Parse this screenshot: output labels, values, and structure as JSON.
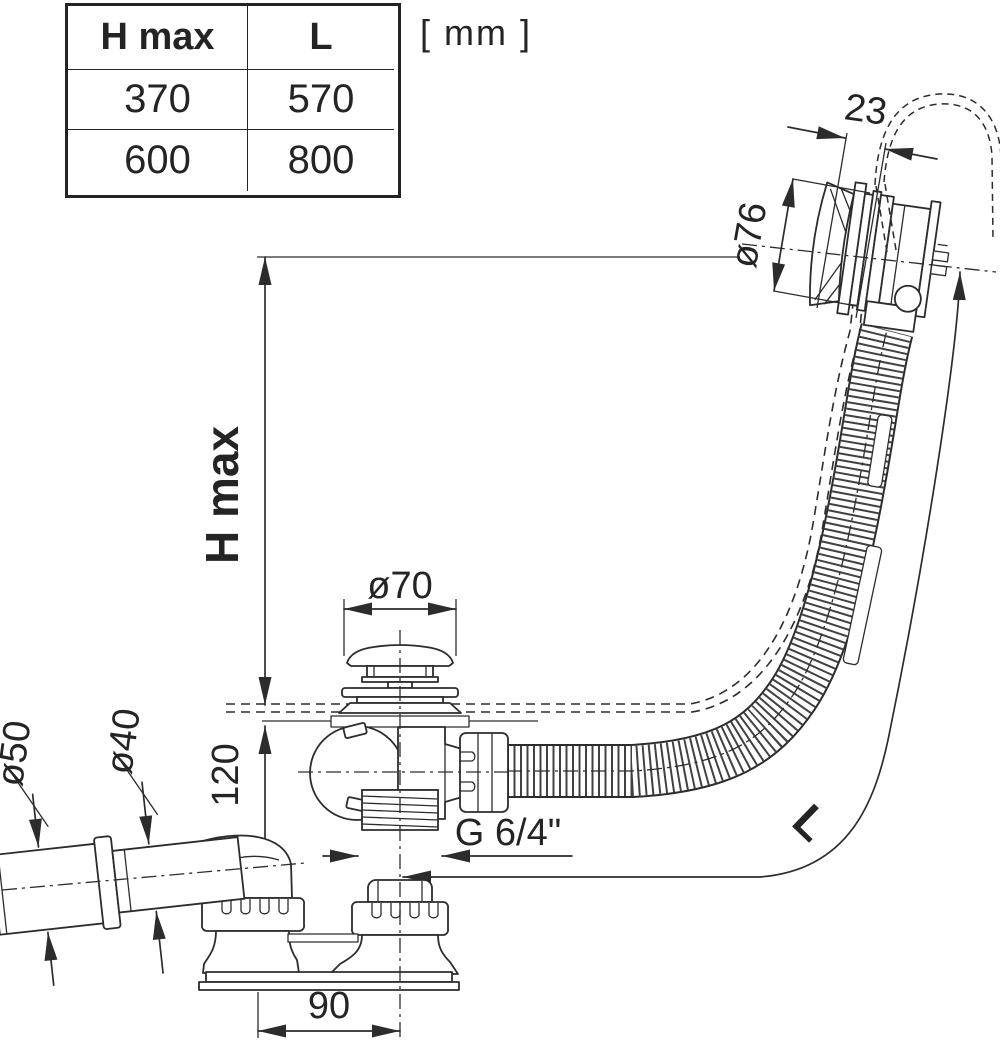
{
  "units_label": "[ mm ]",
  "table": {
    "headers": [
      "H max",
      "L"
    ],
    "rows": [
      [
        "370",
        "570"
      ],
      [
        "600",
        "800"
      ]
    ]
  },
  "dimensions": {
    "h_max": "H max",
    "h120": "120",
    "dia70": "ø70",
    "dia50": "ø50",
    "dia40": "ø40",
    "d23": "23",
    "dia76": "ø76",
    "thread": "G 6/4\"",
    "d90": "90",
    "length": "L"
  },
  "drawing": {
    "type": "technical-drawing",
    "subject": "bath waste and overflow set with bowden-cable overflow head, corrugated hose, drain plug and side outlet",
    "line_color": "#2c2c2c"
  }
}
